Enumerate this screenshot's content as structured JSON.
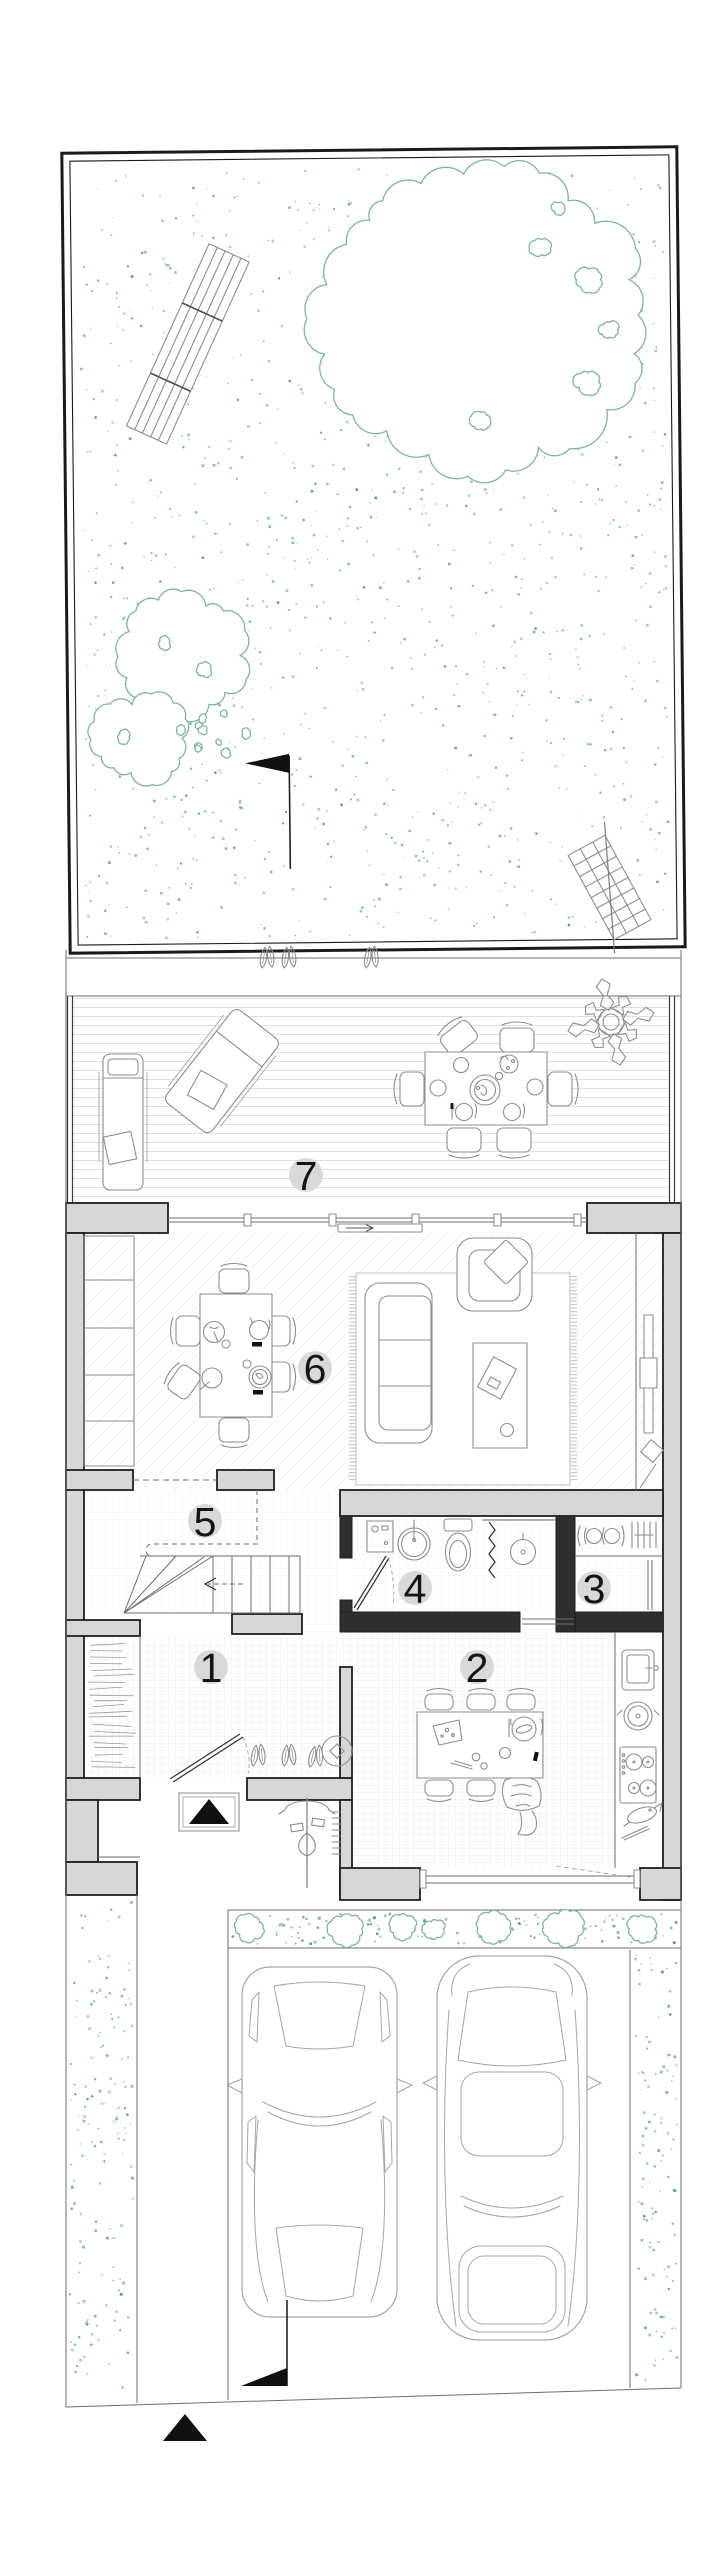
{
  "plan": {
    "kind": "ground-floor-site-plan",
    "rooms": [
      {
        "label": "1"
      },
      {
        "label": "2"
      },
      {
        "label": "3"
      },
      {
        "label": "4"
      },
      {
        "label": "5"
      },
      {
        "label": "6"
      },
      {
        "label": "7"
      }
    ]
  },
  "colors": {
    "vegetation": "#7FB3A7",
    "vegetation_dark": "#5E9C8D",
    "wall_fill": "#D7D7D7",
    "ink": "#1C1C1C",
    "badge_bg": "#D9D9D9",
    "furniture_line": "#8E8E8E"
  }
}
